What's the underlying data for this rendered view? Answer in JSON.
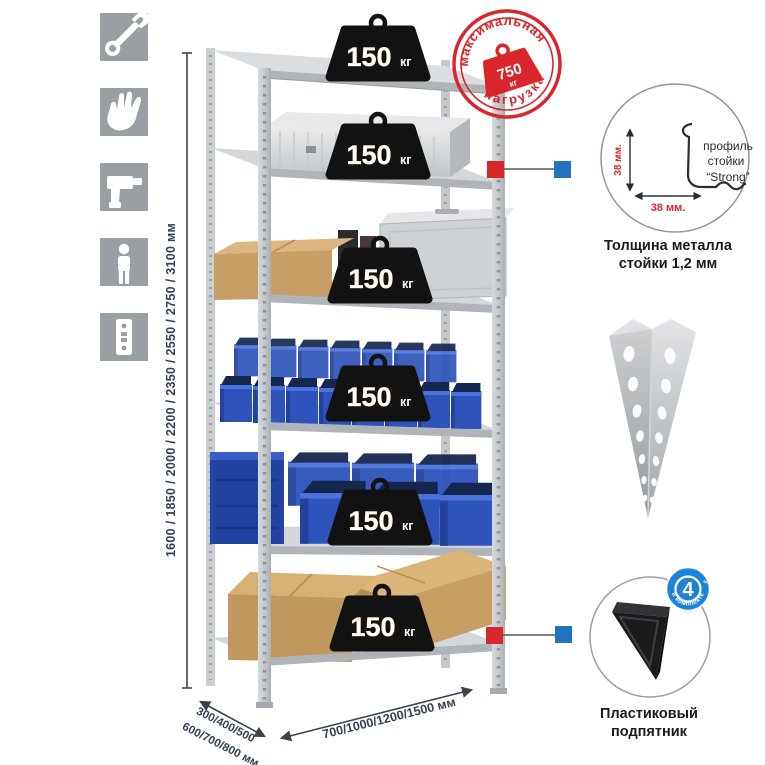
{
  "icons": {
    "bg_color": "#9a9fa3",
    "items": [
      {
        "name": "wrench-icon"
      },
      {
        "name": "gloves-icon"
      },
      {
        "name": "drill-icon"
      },
      {
        "name": "person-icon"
      },
      {
        "name": "rack-profile-icon"
      }
    ]
  },
  "dimensions": {
    "height": "1600 / 1850 / 2000 / 2200 / 2350 / 2550 / 2750 / 3100 мм",
    "depth_line1": "300/400/500",
    "depth_line2": "600/700/800 мм",
    "width": "700/1000/1200/1500 мм"
  },
  "weights": {
    "value": "150",
    "unit": "кг"
  },
  "stamp": {
    "arc_top": "максимальная",
    "arc_bottom": "нагрузка",
    "value": "750",
    "unit": "кг"
  },
  "profile_detail": {
    "line1": "профиль",
    "line2": "стойки",
    "line3": "“Strong”",
    "dim_vertical": "38 мм.",
    "dim_horizontal": "38 мм.",
    "caption1": "Толщина металла",
    "caption2": "стойки 1,2 мм"
  },
  "foot_detail": {
    "badge_number": "4",
    "badge_small": "штуки",
    "badge_arc": "в комплекте",
    "caption1": "Пластиковый",
    "caption2": "подпятник"
  },
  "colors": {
    "accent_red": "#d8262c",
    "marker_blue": "#2173bf",
    "badge_blue": "#1d83d4",
    "bin_blue": "#2e54bb",
    "metal_light": "#d8dbdd",
    "text_dark": "#334055"
  }
}
